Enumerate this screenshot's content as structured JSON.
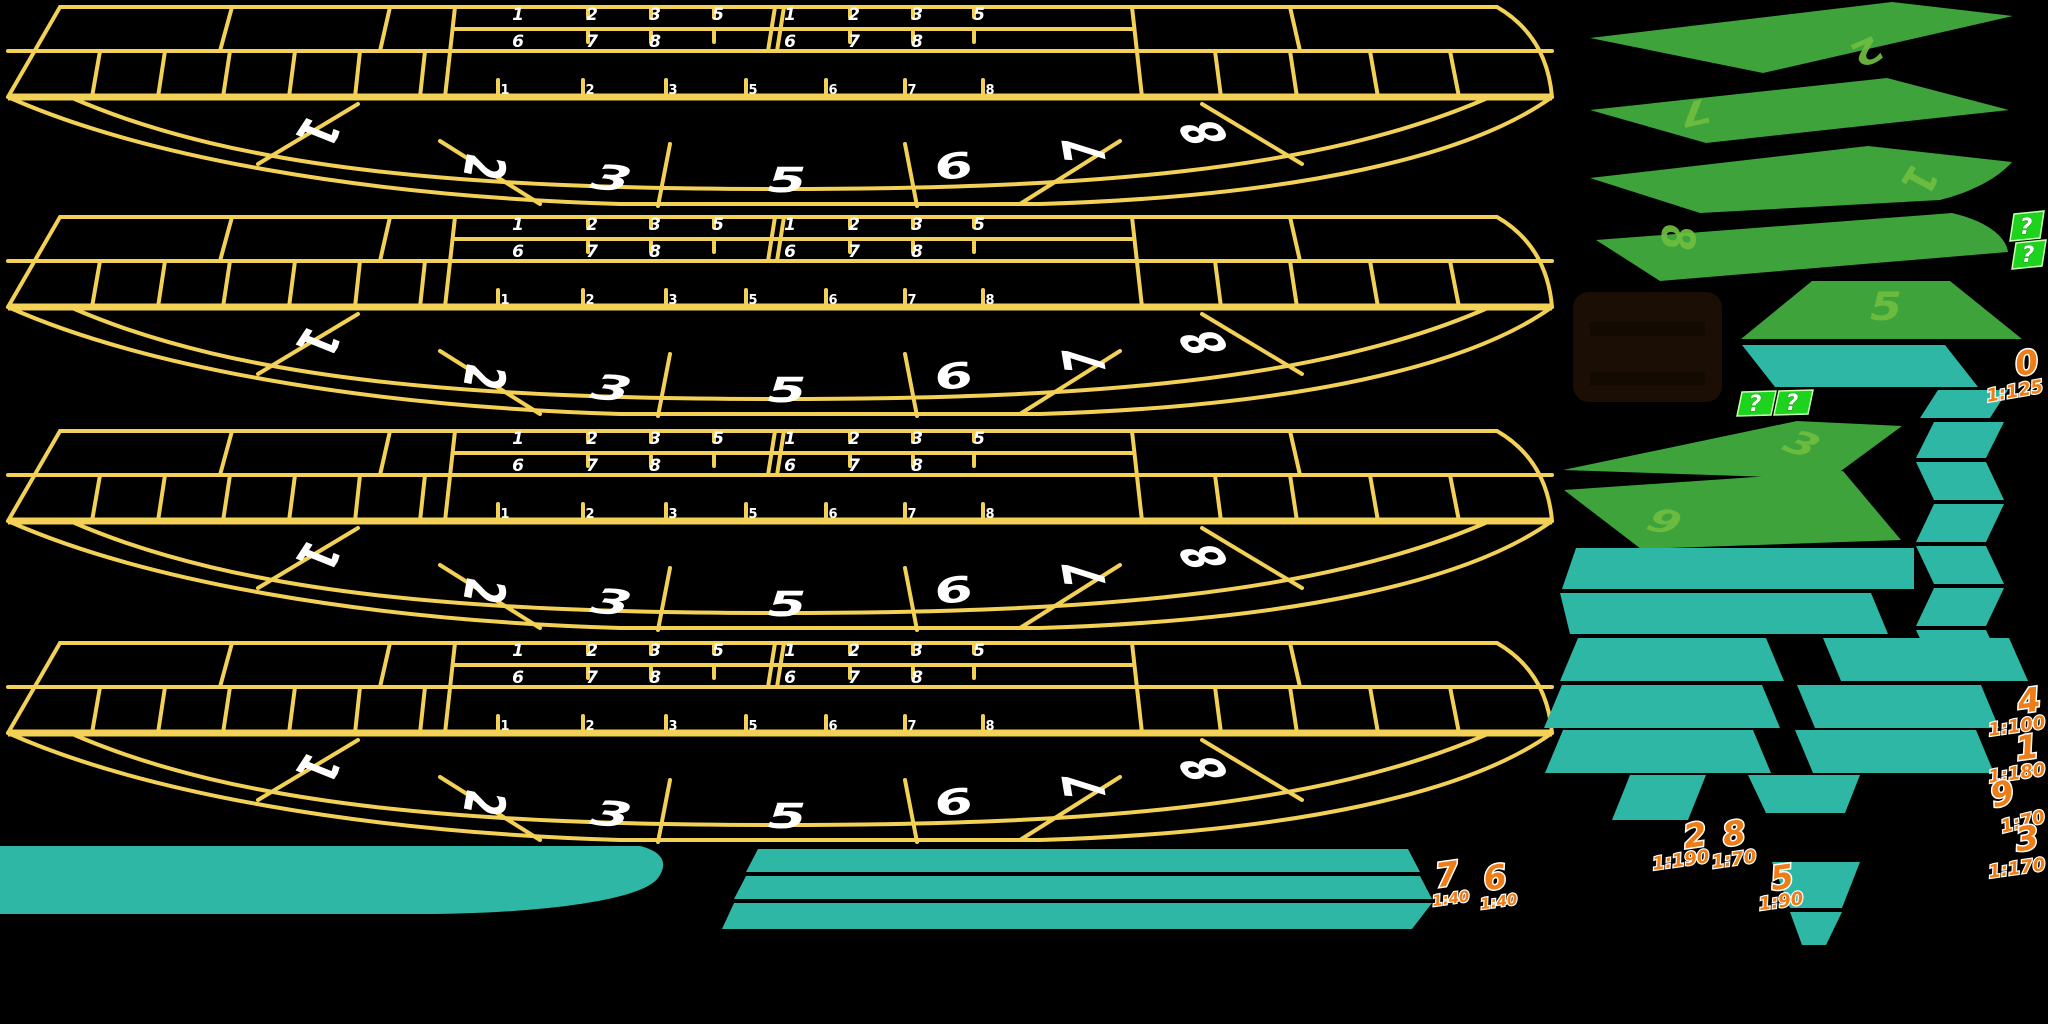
{
  "sheet": {
    "width": 2048,
    "height": 1024,
    "background": "#000000"
  },
  "colors": {
    "table_line_yellow": "#f2d156",
    "seat_number_white": "#ffffff",
    "sector_green": "#3fa33c",
    "sector_number_green": "#6fbf3f",
    "teal": "#2fb7a6",
    "odds_orange": "#ee7d17",
    "mystery_tag_green": "#1ed31e",
    "panel_brown": "#1b0e05"
  },
  "tables": [
    {
      "name": "table-sprite-1",
      "grid_a_row1": [
        "1",
        "2",
        "3",
        "5"
      ],
      "grid_a_row2": [
        "6",
        "7",
        "8"
      ],
      "grid_b_row1": [
        "1",
        "2",
        "3",
        "5"
      ],
      "grid_b_row2": [
        "6",
        "7",
        "8"
      ],
      "strip": [
        "1",
        "2",
        "3",
        "5",
        "6",
        "7",
        "8"
      ],
      "seats": [
        "1",
        "2",
        "3",
        "5",
        "6",
        "7",
        "8"
      ]
    },
    {
      "name": "table-sprite-2",
      "grid_a_row1": [
        "1",
        "2",
        "3",
        "5"
      ],
      "grid_a_row2": [
        "6",
        "7",
        "8"
      ],
      "grid_b_row1": [
        "1",
        "2",
        "3",
        "5"
      ],
      "grid_b_row2": [
        "6",
        "7",
        "8"
      ],
      "strip": [
        "1",
        "2",
        "3",
        "5",
        "6",
        "7",
        "8"
      ],
      "seats": [
        "1",
        "2",
        "3",
        "5",
        "6",
        "7",
        "8"
      ]
    },
    {
      "name": "table-sprite-3",
      "grid_a_row1": [
        "1",
        "2",
        "3",
        "5"
      ],
      "grid_a_row2": [
        "6",
        "7",
        "8"
      ],
      "grid_b_row1": [
        "1",
        "2",
        "3",
        "5"
      ],
      "grid_b_row2": [
        "6",
        "7",
        "8"
      ],
      "strip": [
        "1",
        "2",
        "3",
        "5",
        "6",
        "7",
        "8"
      ],
      "seats": [
        "1",
        "2",
        "3",
        "5",
        "6",
        "7",
        "8"
      ]
    },
    {
      "name": "table-sprite-4",
      "grid_a_row1": [
        "1",
        "2",
        "3",
        "5"
      ],
      "grid_a_row2": [
        "6",
        "7",
        "8"
      ],
      "grid_b_row1": [
        "1",
        "2",
        "3",
        "5"
      ],
      "grid_b_row2": [
        "6",
        "7",
        "8"
      ],
      "strip": [
        "1",
        "2",
        "3",
        "5",
        "6",
        "7",
        "8"
      ],
      "seats": [
        "1",
        "2",
        "3",
        "5",
        "6",
        "7",
        "8"
      ]
    }
  ],
  "sectors": [
    {
      "number": "2"
    },
    {
      "number": "7"
    },
    {
      "number": "1"
    },
    {
      "number": "8"
    },
    {
      "number": "5"
    },
    {
      "number": "3"
    },
    {
      "number": "6"
    }
  ],
  "mystery_tags": [
    "?",
    "?",
    "?",
    "?"
  ],
  "odds": [
    {
      "number": "0",
      "ratio": "1:125"
    },
    {
      "number": "4",
      "ratio": "1:100"
    },
    {
      "number": "1",
      "ratio": "1:180"
    },
    {
      "number": "9",
      "ratio": "1:70"
    },
    {
      "number": "3",
      "ratio": "1:170"
    },
    {
      "number": "2",
      "ratio": "1:190"
    },
    {
      "number": "8",
      "ratio": "1:70"
    },
    {
      "number": "5",
      "ratio": "1:90"
    },
    {
      "number": "7",
      "ratio": "1:40"
    },
    {
      "number": "6",
      "ratio": "1:40"
    }
  ]
}
